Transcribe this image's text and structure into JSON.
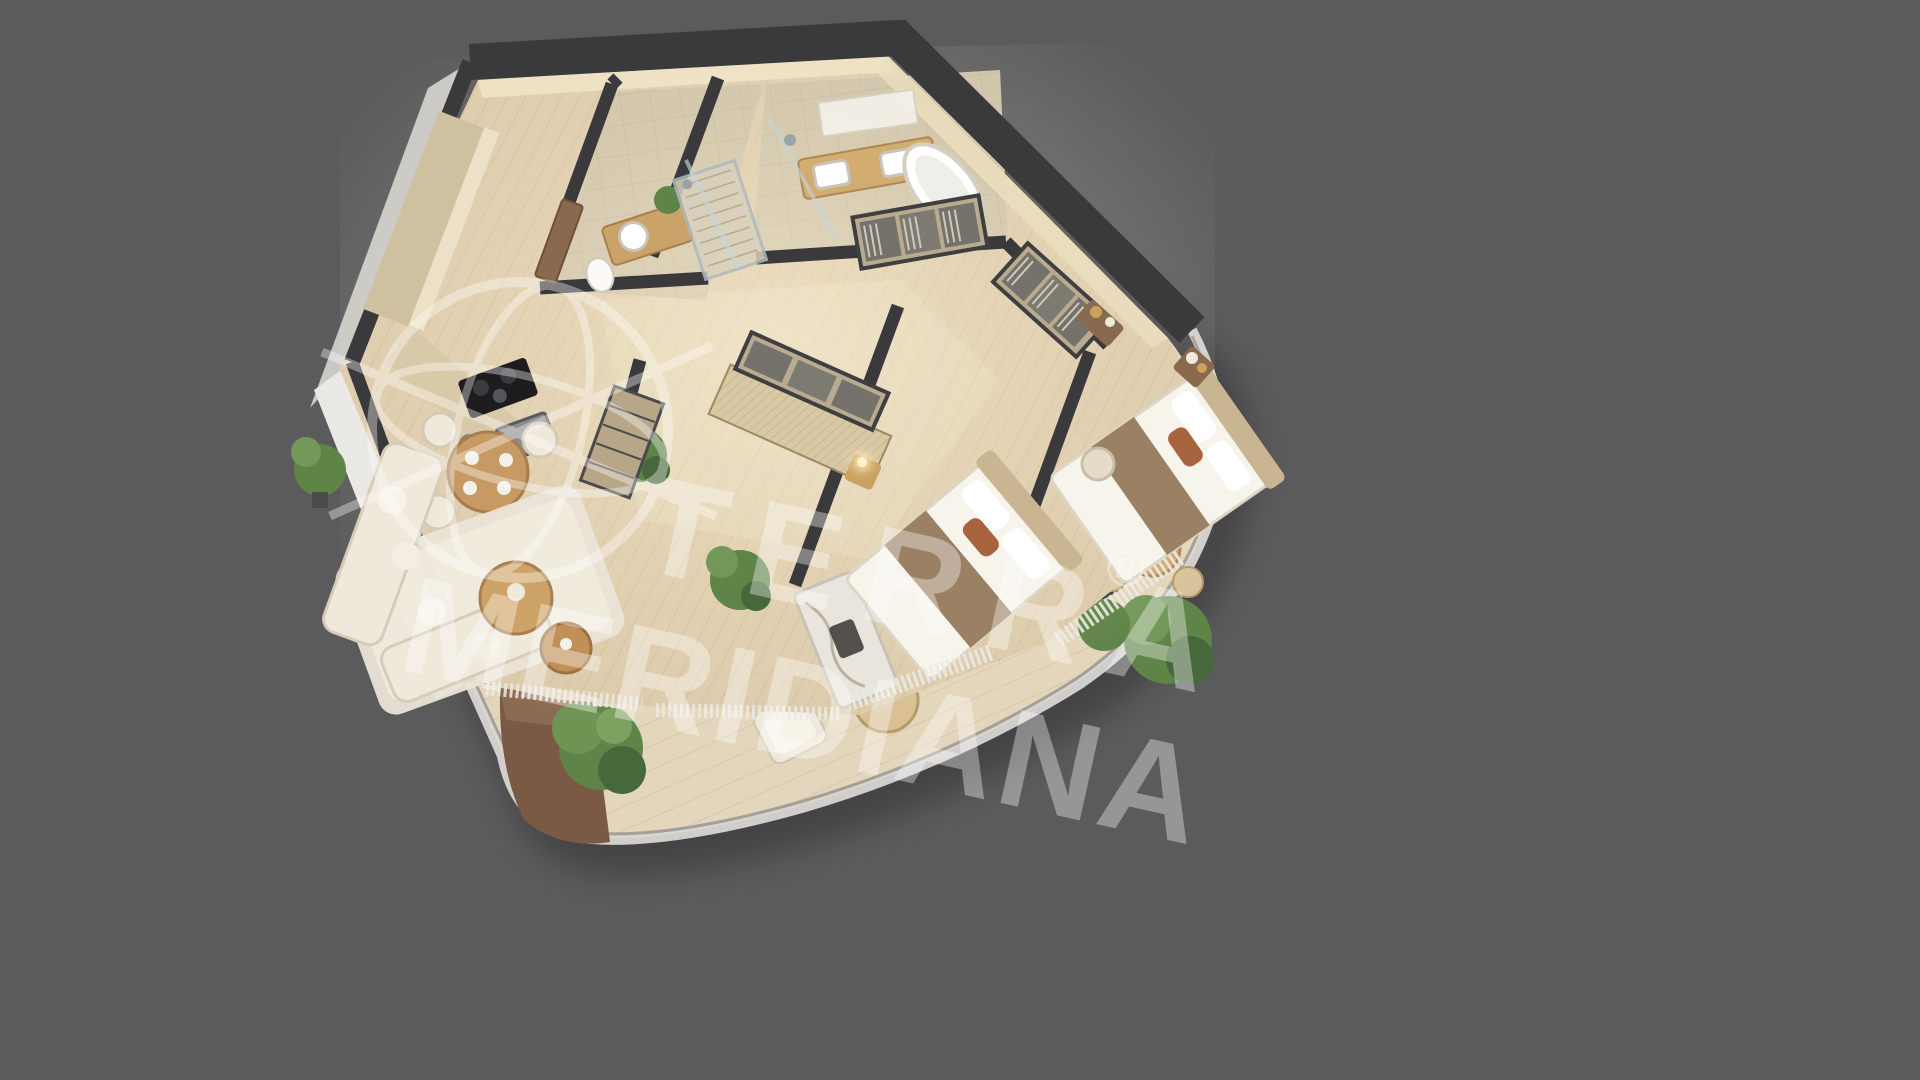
{
  "image": {
    "description": "3D isometric cutaway floor plan render of a two-bedroom apartment with wrap-around curved terrace, viewed from above on a plain grey background",
    "background_color": "#5b5b5d"
  },
  "watermark": {
    "brand_line1": "TERRA",
    "registered_mark": "®",
    "brand_line2": "MERIDIANA",
    "logo": "globe-meridians-icon",
    "text_color": "#ffffff",
    "opacity": "0.36"
  },
  "palette": {
    "background": "#5b5b5d",
    "wall_top": "#3a3a3c",
    "wall_outer_face": "#dddcd9",
    "wall_outer_shade": "#bcbbb8",
    "interior_wall_cream": "#f0e4c6",
    "wood_floor": "#dccbab",
    "wood_plank_line": "#b08f63",
    "terrace_deck": "#e4d6bc",
    "tile_floor": "#cdc1a7",
    "cabinet_wood": "#cfc0a0",
    "furniture_wood": "#c79a63",
    "upholstery_cream": "#efe9dc",
    "bedding_white": "#f7f4ec",
    "blanket_brown": "#9b8164",
    "pillow_rust": "#a8643f",
    "plant_green": "#5f8448",
    "plant_green_dark": "#46683a",
    "planter_brown": "#7a5a45",
    "copper_wall": "#96603c",
    "door_brown": "#8a6a4e",
    "glass_curb": "#d8d6d2",
    "marble": "#e9e5dc"
  },
  "scene": {
    "type": "apartment-3d-floor-plan",
    "rooms": [
      {
        "name": "kitchen",
        "furniture": [
          "wall-cabinets",
          "induction-hob",
          "built-in-oven",
          "countertop-appliances"
        ]
      },
      {
        "name": "dining-area",
        "furniture": [
          "round-dining-table",
          "four-chairs",
          "tableware",
          "potted-plant"
        ]
      },
      {
        "name": "living-room",
        "furniture": [
          "corner-sofa",
          "area-rug",
          "round-coffee-tables",
          "marble-fireplace-wall",
          "sheer-curtains"
        ]
      },
      {
        "name": "entry-hall",
        "furniture": [
          "entrance-door",
          "open-shelving-unit",
          "monstera-plant"
        ]
      },
      {
        "name": "bathroom",
        "furniture": [
          "vanity-with-round-sink",
          "mirror",
          "walk-in-shower",
          "toilet",
          "plant"
        ]
      },
      {
        "name": "master-bathroom",
        "furniture": [
          "double-vanity",
          "freestanding-bathtub",
          "walk-in-shower",
          "glass-partition"
        ]
      },
      {
        "name": "walk-in-closet",
        "furniture": [
          "open-wardrobes-with-clothes",
          "console-table"
        ]
      },
      {
        "name": "bedroom-two",
        "furniture": [
          "double-bed",
          "nightstand-with-lamp",
          "fluted-wardrobe-with-clothes",
          "curtains"
        ]
      },
      {
        "name": "master-bedroom",
        "furniture": [
          "double-bed",
          "nightstand",
          "pouf",
          "wardrobe-with-clothes",
          "curtains"
        ]
      },
      {
        "name": "terrace",
        "furniture": [
          "curved-glass-balustrade",
          "outdoor-sofa",
          "outdoor-armchair",
          "round-outdoor-table",
          "outdoor-dining-set",
          "potted-trees",
          "planter-wall"
        ]
      }
    ],
    "structure": [
      "dark-wall-top-bands",
      "white-exterior-walls",
      "copper-curved-wall",
      "brown-planter-wedge"
    ]
  }
}
